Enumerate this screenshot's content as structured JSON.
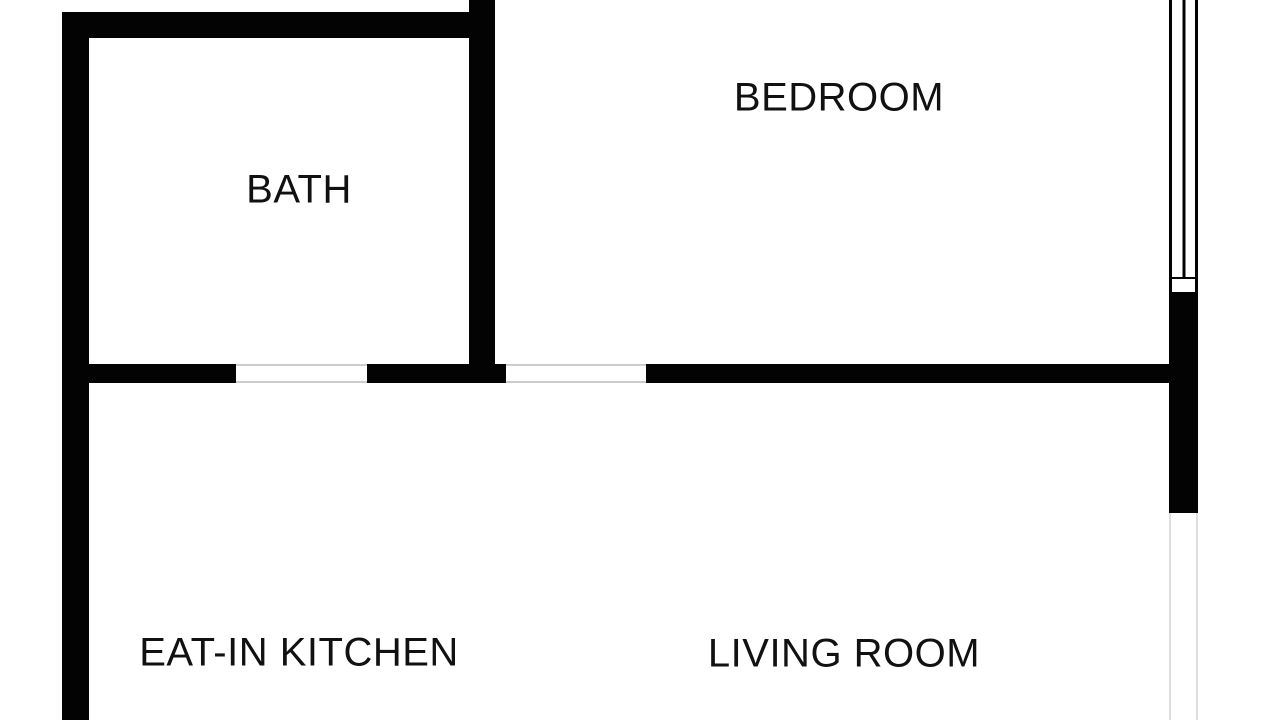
{
  "floorplan": {
    "rooms": [
      {
        "id": "bath",
        "label": "BATH"
      },
      {
        "id": "bedroom",
        "label": "BEDROOM"
      },
      {
        "id": "kitchen",
        "label": "EAT-IN KITCHEN"
      },
      {
        "id": "living-room",
        "label": "LIVING ROOM"
      }
    ],
    "features": {
      "window": "window-double-line",
      "door_openings": [
        "bath-door-opening",
        "bedroom-door-opening"
      ]
    },
    "colors": {
      "wall": "#030303",
      "background": "#ffffff",
      "door_frame": "#cccccc",
      "faint_wall": "#dddddd",
      "label": "#111111"
    }
  }
}
